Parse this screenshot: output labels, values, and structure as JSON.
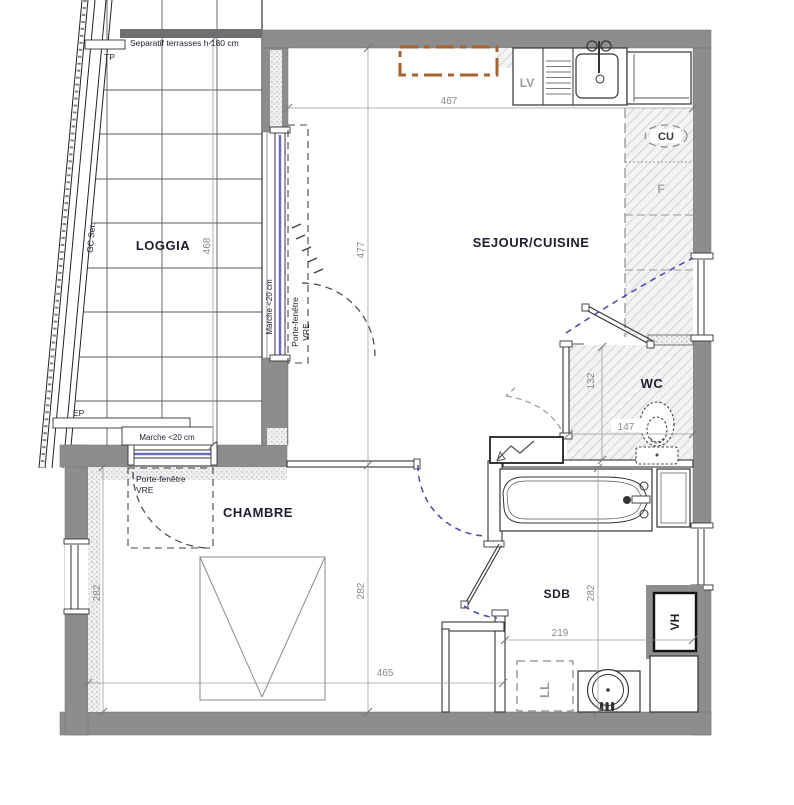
{
  "plan_title": "Plan appartement T2",
  "rooms": {
    "loggia": "LOGGIA",
    "sejour_cuisine": "SEJOUR/CUISINE",
    "chambre": "CHAMBRE",
    "wc": "WC",
    "sdb": "SDB"
  },
  "dims": {
    "sejour_width": "467",
    "sejour_height": "477",
    "loggia_height": "468",
    "chambre_width": "465",
    "chambre_height_left": "282",
    "chambre_height_mid": "282",
    "sdb_height": "282",
    "sdb_width": "219",
    "wc_width": "147",
    "wc_height": "132",
    "wall_thickness": "18"
  },
  "annotations": {
    "separatif": "Separatif terrasses h 180 cm",
    "tp": "TP",
    "ep": "EP",
    "gc_ser": "GC Ser.",
    "marche_loggia": "Marche <20 cm",
    "marche_chambre": "Marche <20 cm",
    "porte_fenetre_sejour": "Porte-fenêtre",
    "porte_fenetre_sejour_type": "VRE",
    "porte_fenetre_chambre": "Porte-fenêtre",
    "porte_fenetre_chambre_type": "VRE",
    "lv": "LV",
    "cu": "CU",
    "f": "F",
    "ll": "LL",
    "vh": "VH"
  },
  "colors": {
    "wall": "#8d8d8d",
    "glazing_blue": "#6b6bc0",
    "door_arc_blue": "#4646b4",
    "cabinet_orange": "#a9622b",
    "dim_gray": "#8a8a8a"
  }
}
